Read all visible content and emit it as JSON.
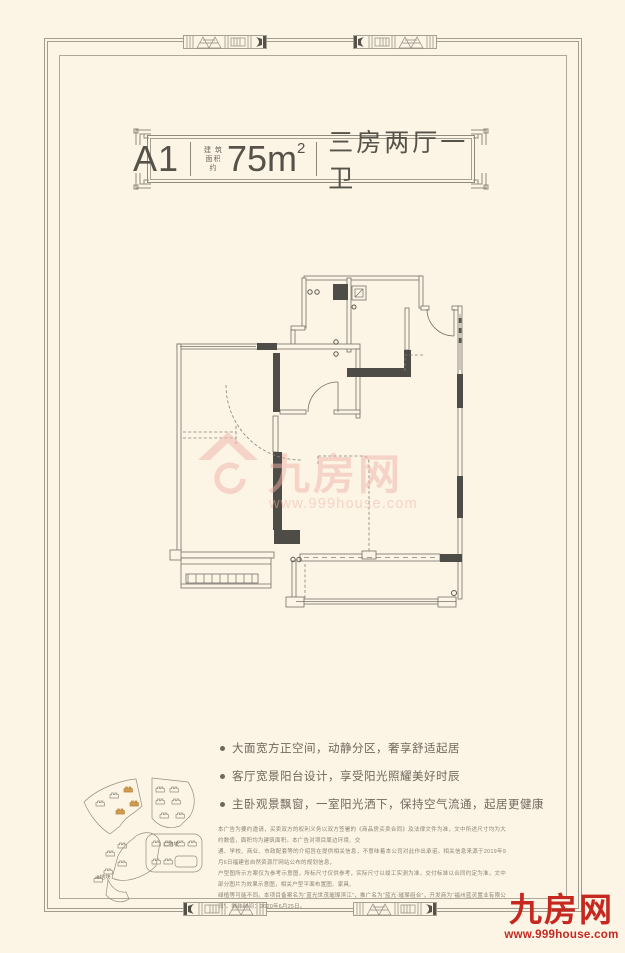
{
  "page": {
    "background": "#fcf4e5",
    "frame_color": "#a19d8e"
  },
  "header": {
    "unit": "A1",
    "area_label_line1": "建 筑",
    "area_label_line2": "面积约",
    "area_value": "75m",
    "area_exponent": "2",
    "layout": "三房两厅一卫"
  },
  "watermark": {
    "brand": "九房网",
    "site": "www.999house.com",
    "color": "#f0b3a9"
  },
  "highlights": [
    "大面宽方正空间，动静分区，奢享舒适起居",
    "客厅宽景阳台设计，享受阳光照耀美好时辰",
    "主卧观景飘窗，一室阳光洒下，保持空气流通，起居更健康"
  ],
  "sitemap": {
    "parcel_a": "A地块",
    "parcel_c": "C地块"
  },
  "disclaimer": {
    "lines": [
      "本广告为要约邀请，买卖双方的权利义务以双方签署的《商品房买卖合同》及法律文件为准，文中所述尺寸均为大约数值，面积均为建筑面积。本广告对项目周边环境、交",
      "通、学校、商业、市政配套等的介绍旨在提供相关信息，不意味着本公司对此作出承诺。相关信息来源于2019年9月6日福建省自然资源厅网站公布的规划信息，",
      "户型图所示方案仅为参考示意图，所标尺寸仅供参考，实际尺寸以竣工实测为准，交付标准以合同约定为准，文中部分图片为效果示意图，相关户型平面布置图、家具、",
      "绿植等可能不同。本项目备案名为“蓝光世茂璀璨滨江”，推广名为“蓝光·璀璨组合”，开发商为“福州蓝灵置业有限公司”。制作时间：2020年6月25日。"
    ]
  },
  "brand_logo": {
    "name": "九房网",
    "site": "www.999house.com",
    "color": "#c62820"
  }
}
